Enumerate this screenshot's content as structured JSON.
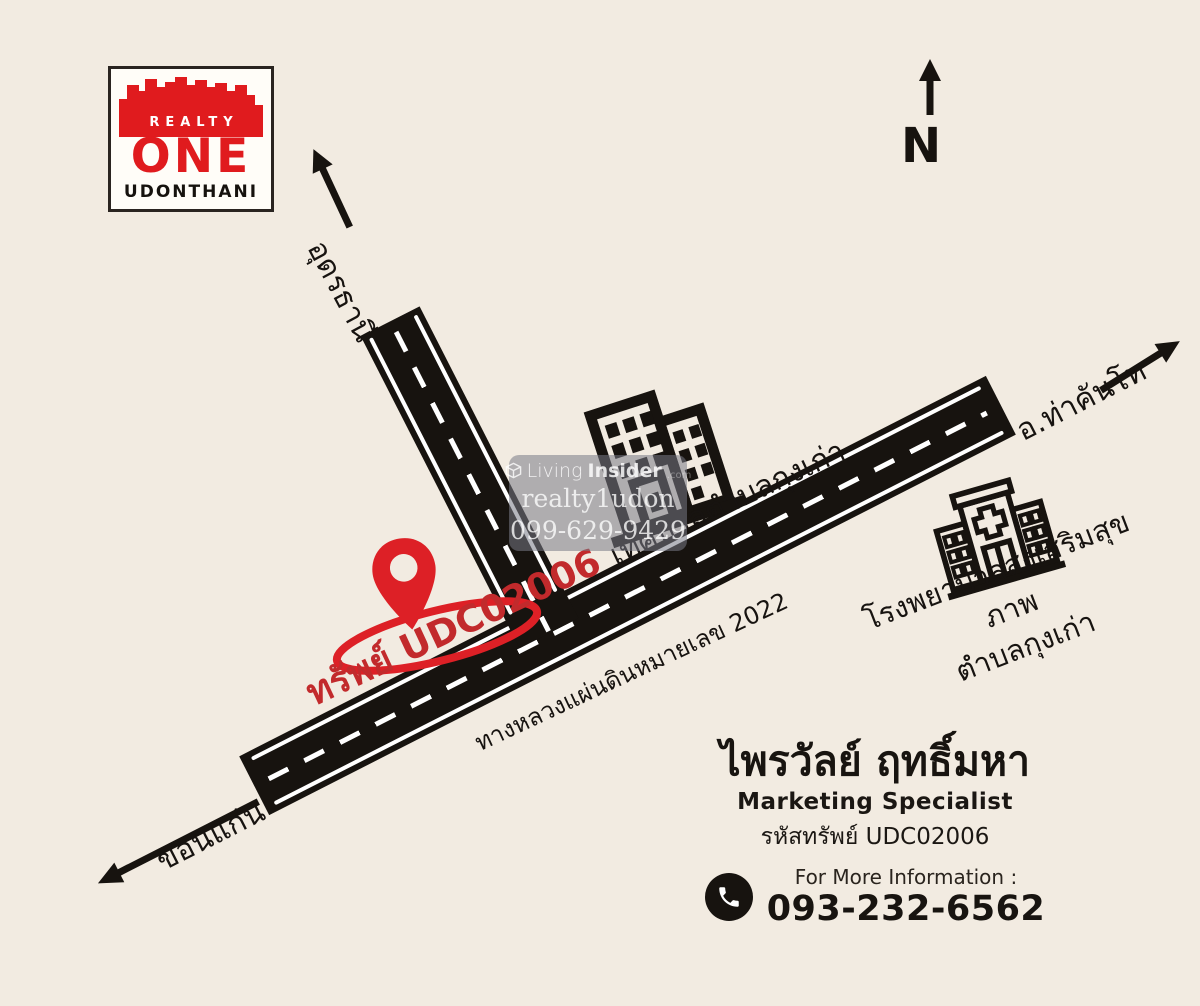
{
  "canvas": {
    "bg": "#f2ebe1",
    "road_color": "#17130f",
    "brand_red": "#e01b1e",
    "pin_red": "#dd2026"
  },
  "logo": {
    "realty": "REALTY",
    "one": "ONE",
    "city": "UDONTHANI"
  },
  "compass": {
    "label": "N"
  },
  "destinations": {
    "north": "อุดรธานี",
    "southwest": "ขอนแก่น",
    "northeast": "อ.ท่าคันโท"
  },
  "places": {
    "municipality": "เทศบาลตำบลกุงเก่า",
    "hospital_line1": "โรงพยาบาลส่งเสริมสุขภาพ",
    "hospital_line2": "ตำบลกุงเก่า"
  },
  "highway": {
    "label": "ทางหลวงแผ่นดินหมายเลข 2022"
  },
  "property": {
    "pin_label": "ทรัพย์ UDC02006"
  },
  "watermark": {
    "brand_light": "Living",
    "brand_bold": "Insider",
    "brand_suffix": ".com",
    "line2": "realty1udon",
    "line3": "099-629-9429"
  },
  "contact": {
    "name": "ไพรวัลย์ ฤทธิ์มหา",
    "role": "Marketing Specialist",
    "property_code": "รหัสทรัพย์ UDC02006",
    "info_label": "For More Information :",
    "phone": "093-232-6562"
  }
}
